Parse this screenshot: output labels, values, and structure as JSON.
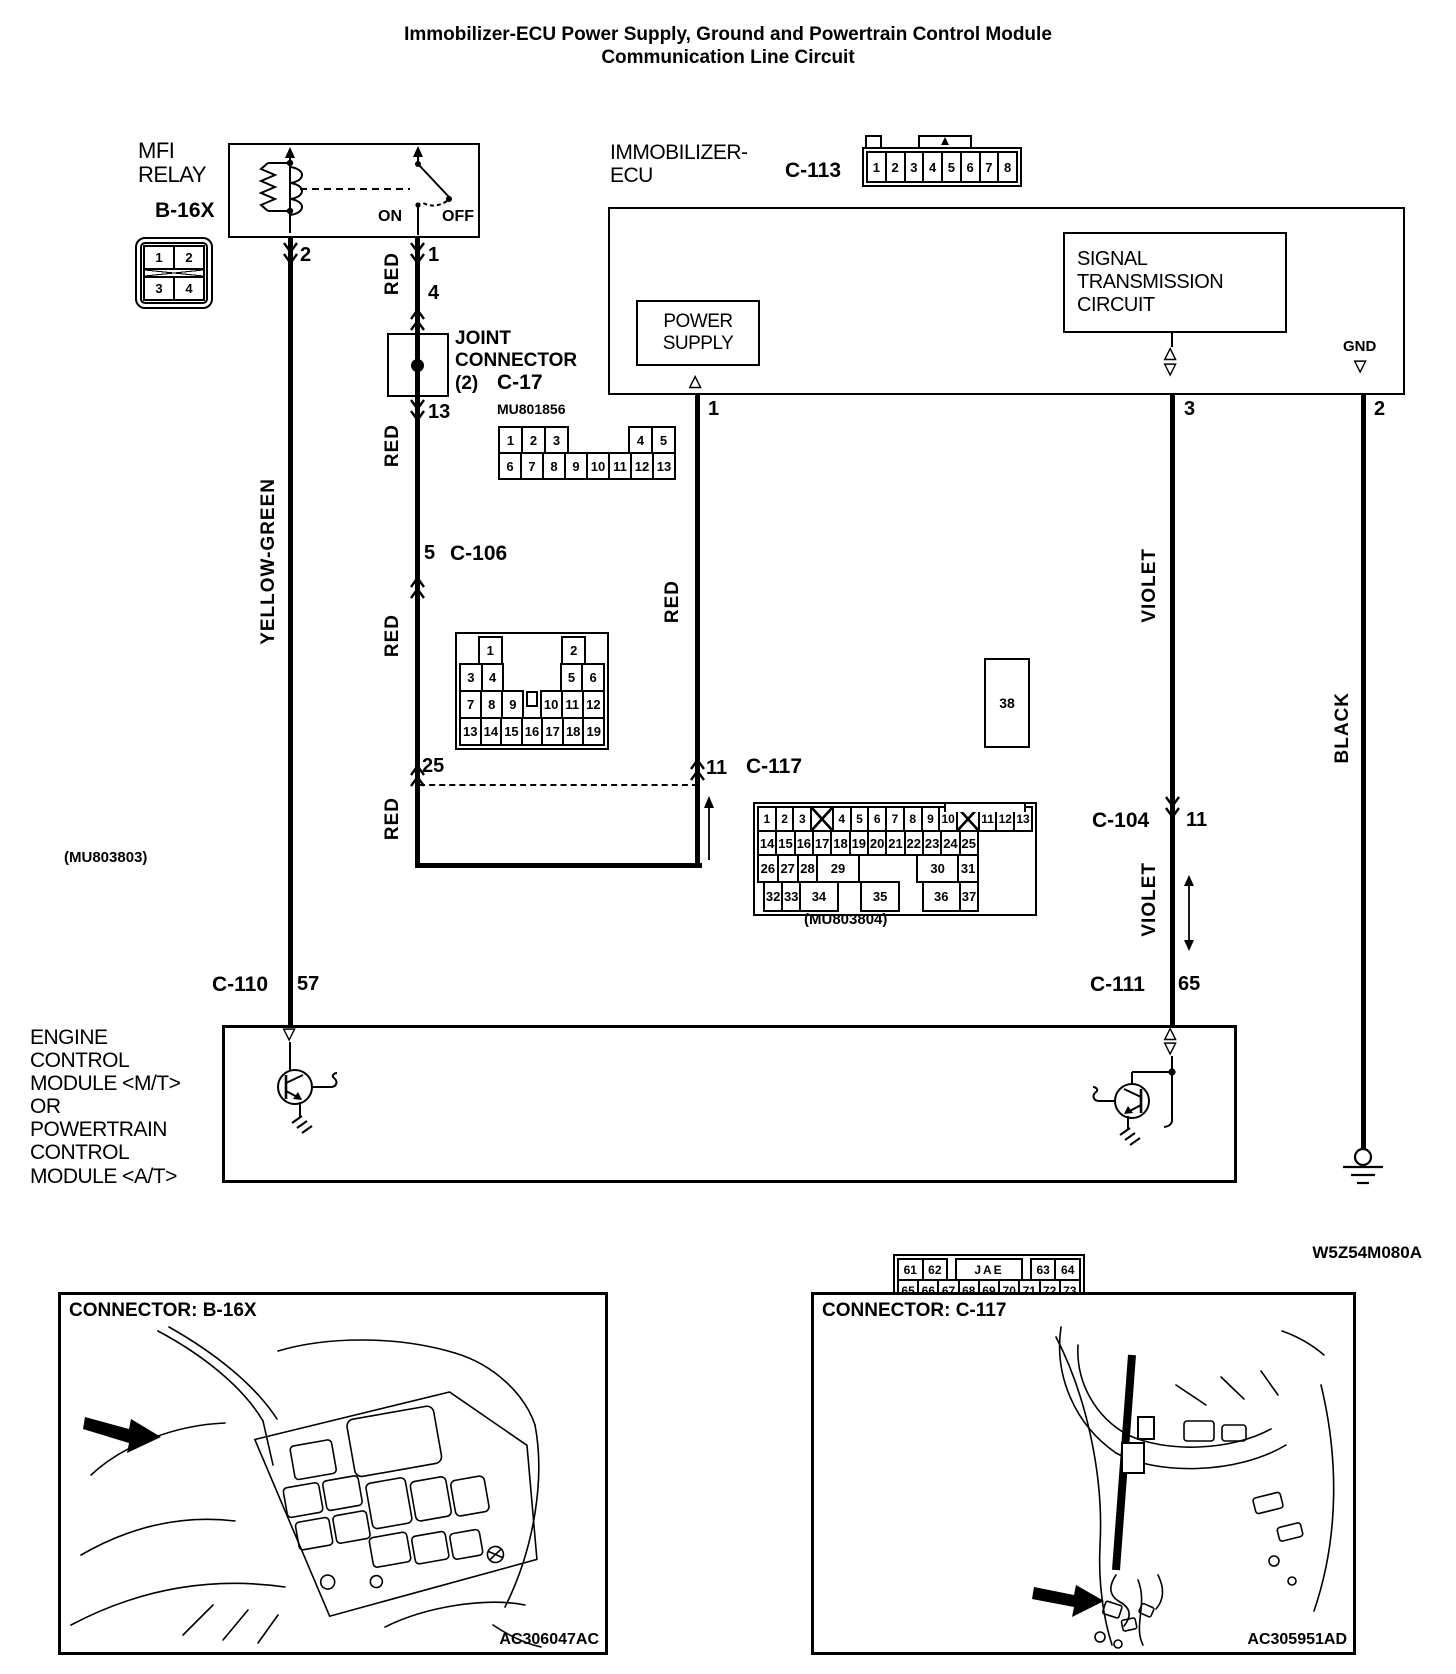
{
  "title": {
    "line1": "Immobilizer-ECU Power Supply, Ground and Powertrain Control Module",
    "line2": "Communication Line Circuit"
  },
  "doc_code": "W5Z54M080A",
  "relay": {
    "name1": "MFI",
    "name2": "RELAY",
    "connector": "B-16X",
    "on": "ON",
    "off": "OFF"
  },
  "ecu": {
    "name1": "IMMOBILIZER-",
    "name2": "ECU",
    "connector_label": "C-113",
    "ps1": "POWER",
    "ps2": "SUPPLY",
    "sig1": "SIGNAL",
    "sig2": "TRANSMISSION",
    "sig3": "CIRCUIT",
    "gnd": "GND"
  },
  "joint": {
    "l1": "JOINT",
    "l2": "CONNECTOR",
    "l3": "(2)",
    "name": "C-17",
    "part": "MU801856"
  },
  "wires": {
    "yellow_green": "YELLOW-GREEN",
    "red": "RED",
    "violet": "VIOLET",
    "black": "BLACK"
  },
  "pins": {
    "relay_p2": "2",
    "relay_p1": "1",
    "joint_in": "4",
    "joint_out": "13",
    "c106_pin": "5",
    "c117_in": "25",
    "c117_out": "11",
    "ecu_p1": "1",
    "ecu_p3": "3",
    "ecu_p2": "2",
    "c104_pin": "11",
    "c111_pin": "65",
    "c110_pin": "57"
  },
  "names": {
    "c106": "C-106",
    "c117": "C-117",
    "c104": "C-104",
    "c111": "C-111",
    "c110": "C-110"
  },
  "parts": {
    "mu803803": "(MU803803)",
    "mu803804": "(MU803804)"
  },
  "ecm": {
    "lines": [
      "ENGINE",
      "CONTROL",
      "MODULE <M/T>",
      "OR",
      "POWERTRAIN",
      "CONTROL",
      "MODULE <A/T>"
    ]
  },
  "insets": {
    "left": {
      "title": "CONNECTOR: B-16X",
      "code": "AC306047AC"
    },
    "right": {
      "title": "CONNECTOR: C-117",
      "code": "AC305951AD"
    }
  },
  "connectors": {
    "b16x": {
      "rows": [
        {
          "rh": 25,
          "cells": [
            "1",
            "2"
          ]
        },
        {
          "rh": 10,
          "cells": [
            {
              "t": "X",
              "w": 1
            }
          ]
        },
        {
          "rh": 25,
          "cells": [
            "3",
            "4"
          ]
        }
      ]
    },
    "c113": {
      "rows": [
        {
          "rh": 32,
          "cells": [
            "1",
            "2",
            "3",
            "4",
            "5",
            "6",
            "7",
            "8"
          ]
        }
      ]
    },
    "c17": {
      "rows": [
        {
          "rh": 28,
          "cells": [
            "1",
            "2",
            "3",
            {
              "t": "",
              "w": 3
            },
            "4",
            "5"
          ]
        },
        {
          "rh": 28,
          "cells": [
            "6",
            "7",
            "8",
            "9",
            "10",
            "11",
            "12",
            "13"
          ]
        }
      ]
    },
    "c106": {
      "rows": [
        {
          "rh": 29,
          "cells": [
            {
              "t": "",
              "w": 1
            },
            "1",
            {
              "t": "",
              "w": 3
            },
            "2",
            {
              "t": "",
              "w": 1
            }
          ]
        },
        {
          "rh": 29,
          "cells": [
            "3",
            "4",
            {
              "t": "",
              "w": 3
            },
            "5",
            "6"
          ]
        },
        {
          "rh": 29,
          "cells": [
            "7",
            "8",
            "9",
            {
              "t": "KEY",
              "w": 1
            },
            "10",
            "11",
            "12"
          ]
        },
        {
          "rh": 29,
          "cells": [
            "13",
            "14",
            "15",
            "16",
            "17",
            "18",
            "19"
          ]
        }
      ]
    },
    "c117": {
      "big": "38",
      "rows": [
        {
          "rh": 26,
          "cells": [
            "1",
            "2",
            "3",
            {
              "t": "X",
              "w": 1.25
            },
            "4",
            "5",
            "6",
            "7",
            "8",
            "9",
            "10",
            {
              "t": "X",
              "w": 1.25
            },
            "11",
            "12",
            "13"
          ]
        },
        {
          "rh": 26,
          "cells": [
            "14",
            "15",
            "16",
            "17",
            "18",
            "19",
            "20",
            "21",
            "22",
            "23",
            "24",
            "25"
          ]
        },
        {
          "rh": 29,
          "cells": [
            "26",
            "27",
            "28",
            {
              "t": "29",
              "w": 2.2
            },
            {
              "t": "",
              "w": 3.4
            },
            {
              "t": "30",
              "w": 2.2
            },
            "31"
          ]
        },
        {
          "rh": 31,
          "cells": [
            {
              "t": "",
              "w": 0.5
            },
            "32",
            "33",
            {
              "t": "34",
              "w": 2.2
            },
            {
              "t": "",
              "w": 1.6
            },
            {
              "t": "35",
              "w": 2.2
            },
            {
              "t": "",
              "w": 1.6
            },
            {
              "t": "36",
              "w": 2.2
            },
            "37"
          ]
        }
      ]
    },
    "c104": {
      "rows": [
        {
          "rh": 27,
          "cells": [
            "1",
            "2",
            "3",
            {
              "t": "O",
              "w": 2
            },
            "4",
            "5",
            "6",
            "7"
          ]
        },
        {
          "rh": 27,
          "cells": [
            "8",
            "9",
            "10",
            "11",
            "12",
            "13",
            "14",
            "15",
            "16"
          ]
        }
      ]
    },
    "c111": {
      "rows": [
        {
          "rh": 23,
          "cells": [
            "61",
            "62",
            {
              "t": "",
              "w": 0.5
            },
            {
              "t": "JAE",
              "w": 2.8
            },
            {
              "t": "",
              "w": 0.5
            },
            "63",
            "64"
          ]
        },
        {
          "rh": 23,
          "cells": [
            "65",
            "66",
            "67",
            "68",
            "69",
            "70",
            "71",
            "72",
            "73"
          ]
        },
        {
          "rh": 23,
          "cells": [
            "74",
            "75",
            "76",
            "77",
            "78",
            "79",
            "80",
            "81",
            "82"
          ]
        },
        {
          "rh": 23,
          "cells": [
            "83",
            "84",
            {
              "t": "",
              "w": 0.8
            },
            "85",
            "86",
            "87",
            {
              "t": "",
              "w": 0.8
            },
            "88",
            "89"
          ]
        }
      ]
    },
    "c110": {
      "rows": [
        {
          "rh": 24,
          "cells": [
            "31",
            "32",
            {
              "t": "",
              "w": 0.4
            },
            {
              "t": "JAE",
              "w": 2.6
            },
            {
              "t": "",
              "w": 0.4
            },
            {
              "t": "33",
              "w": 1.4
            },
            {
              "t": "34",
              "w": 1.4
            }
          ]
        },
        {
          "rh": 24,
          "cells": [
            "35",
            "36",
            "37",
            "38",
            "39",
            "40",
            "41",
            {
              "t": "42",
              "w": 1.3
            },
            {
              "t": "43",
              "w": 1.3
            }
          ]
        },
        {
          "rh": 24,
          "cells": [
            "44",
            "45",
            "46",
            "47",
            "48",
            "49",
            {
              "t": "",
              "w": 0.4
            },
            {
              "t": "50",
              "w": 1.5
            },
            {
              "t": "51",
              "w": 1.5
            }
          ]
        },
        {
          "rh": 24,
          "cells": [
            "52",
            "53",
            {
              "t": "",
              "w": 0.8
            },
            "54",
            "55",
            "56",
            {
              "t": "",
              "w": 0.6
            },
            "57",
            "58"
          ]
        }
      ]
    }
  }
}
